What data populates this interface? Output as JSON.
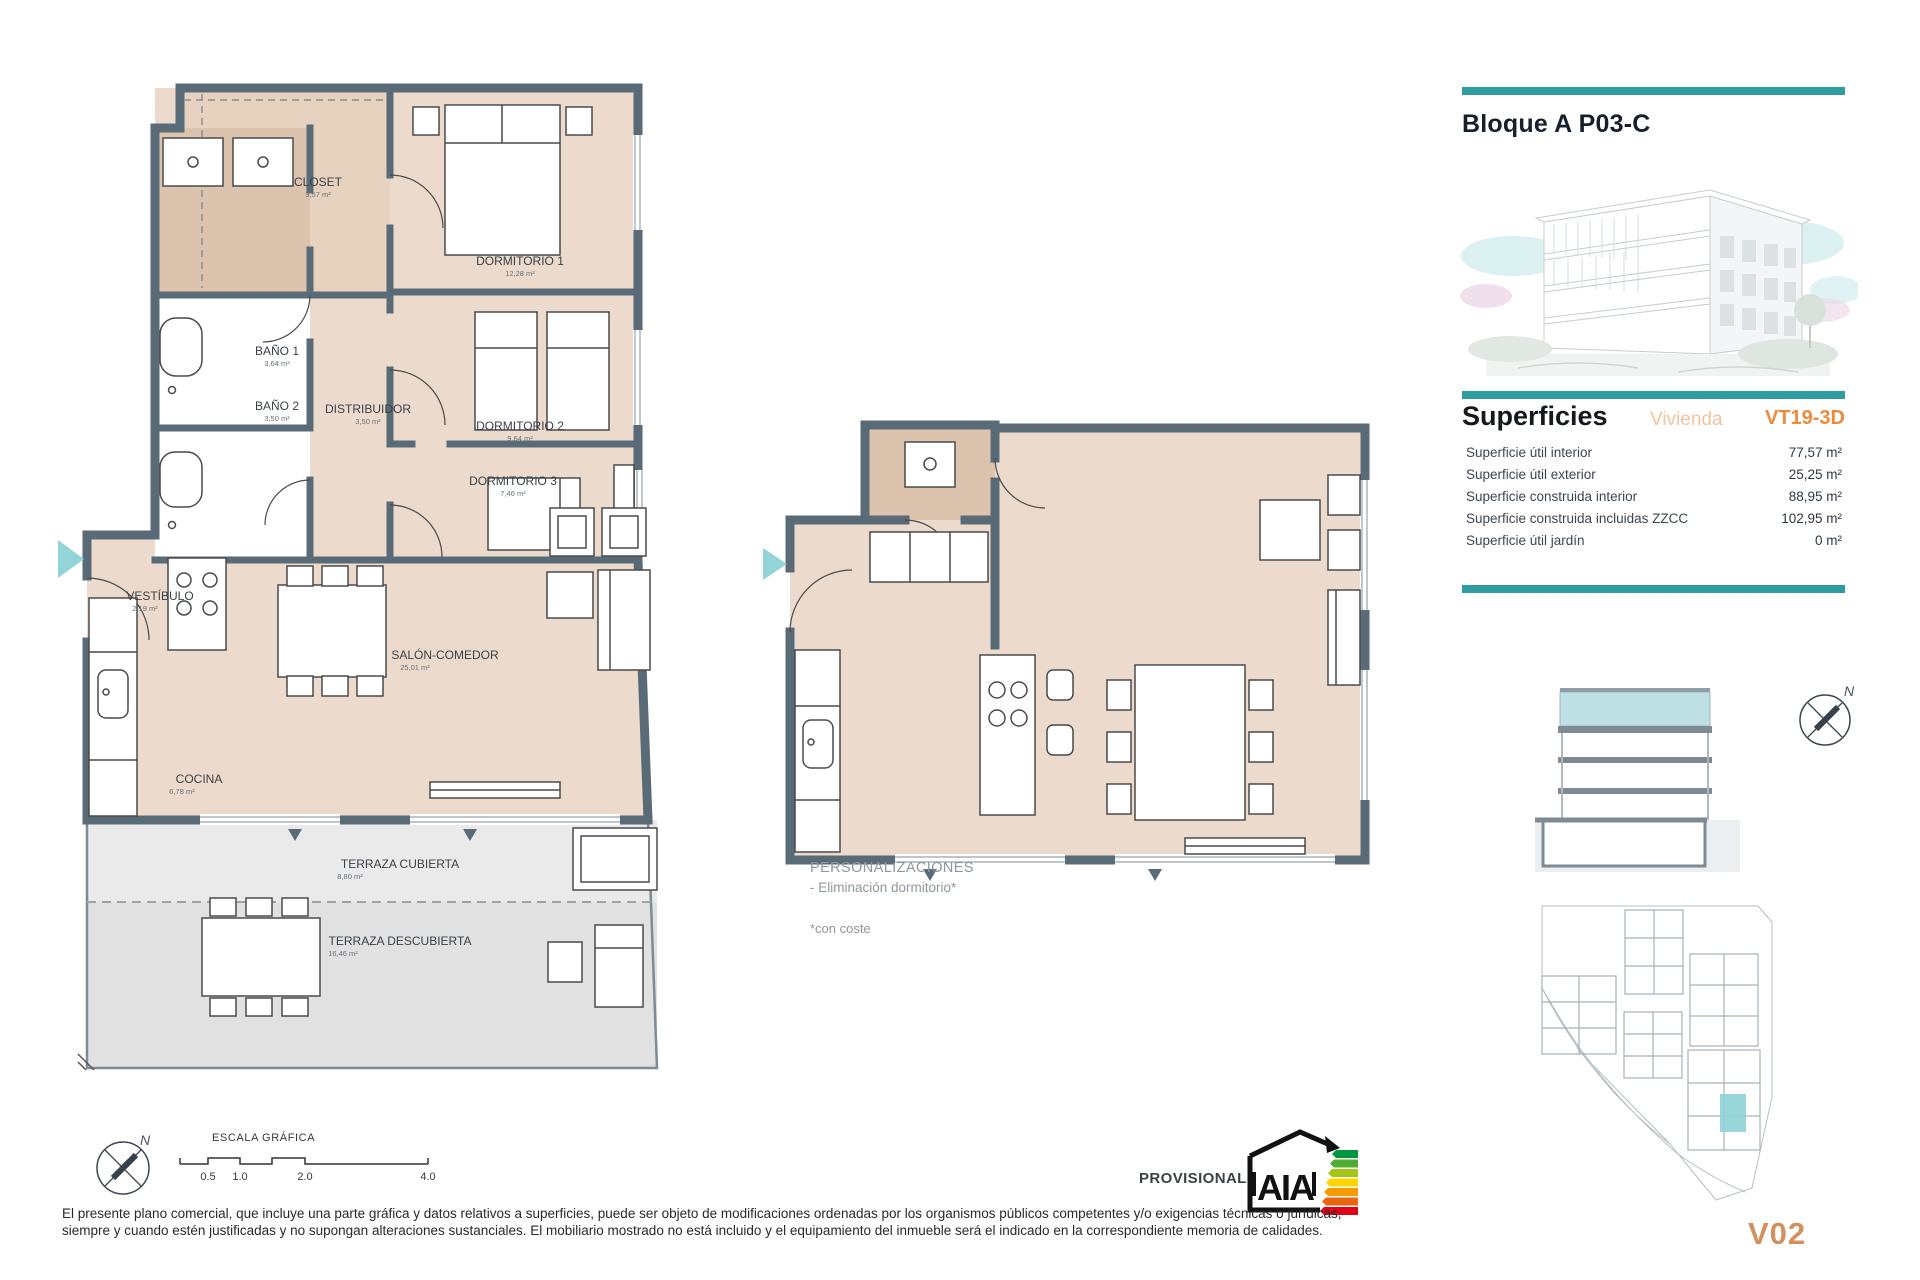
{
  "panel": {
    "title": "Bloque A P03-C",
    "superficies": {
      "heading": "Superficies",
      "subheading": "Vivienda",
      "code": "VT19-3D",
      "rows": [
        {
          "label": "Superficie útil interior",
          "value": "77,57 m²"
        },
        {
          "label": "Superficie útil exterior",
          "value": "25,25 m²"
        },
        {
          "label": "Superficie construida interior",
          "value": "88,95 m²"
        },
        {
          "label": "Superficie construida incluidas ZZCC",
          "value": "102,95 m²"
        },
        {
          "label": "Superficie útil jardín",
          "value": "0 m²"
        }
      ]
    },
    "version": "V02"
  },
  "main_plan": {
    "rooms": [
      {
        "name": "CLOSET",
        "area": "3,57 m²"
      },
      {
        "name": "DORMITORIO 1",
        "area": "12,28 m²"
      },
      {
        "name": "BAÑO 1",
        "area": "3,64 m²"
      },
      {
        "name": "BAÑO 2",
        "area": "3,50 m²"
      },
      {
        "name": "DISTRIBUIDOR",
        "area": "3,50 m²"
      },
      {
        "name": "DORMITORIO 2",
        "area": "9,64 m²"
      },
      {
        "name": "DORMITORIO 3",
        "area": "7,46 m²"
      },
      {
        "name": "VESTÍBULO",
        "area": "2,19 m²"
      },
      {
        "name": "SALÓN-COMEDOR",
        "area": "25,01 m²"
      },
      {
        "name": "COCINA",
        "area": "6,78 m²"
      },
      {
        "name": "TERRAZA CUBIERTA",
        "area": "8,80 m²"
      },
      {
        "name": "TERRAZA DESCUBIERTA",
        "area": "16,46 m²"
      }
    ]
  },
  "personalizaciones": {
    "title": "PERSONALIZACIONES",
    "item": "- Eliminación dormitorio*",
    "note": "*con coste"
  },
  "compass": {
    "north": "N"
  },
  "footer": {
    "scale_label": "ESCALA GRÁFICA",
    "scale_ticks": [
      "0.5",
      "1.0",
      "2.0",
      "4.0"
    ],
    "provisional": "PROVISIONAL",
    "energy_logo": "AIA",
    "disclaimer": "El presente plano comercial, que incluye una parte gráfica y datos relativos a superficies, puede ser objeto de modificaciones ordenadas por los organismos públicos competentes y/o exigencias técnicas o jurídicas, siempre y cuando estén justificadas y no supongan alteraciones sustanciales. El mobiliario mostrado no está incluido y el equipamiento del inmueble será el indicado en la correspondiente memoria de calidades."
  },
  "colors": {
    "accent_teal": "#2E9CA1",
    "code_orange": "#EE8A3C",
    "vivienda_orange": "#F2C49C",
    "version_orange": "#D2905E",
    "wall": "#5A6B78",
    "floor": "#ECDBCC",
    "wet_floor": "#DCC3AE",
    "terrace": "#EAEAEA",
    "entry_arrow": "#93D4D9",
    "site_highlight": "#8ED2D6"
  }
}
